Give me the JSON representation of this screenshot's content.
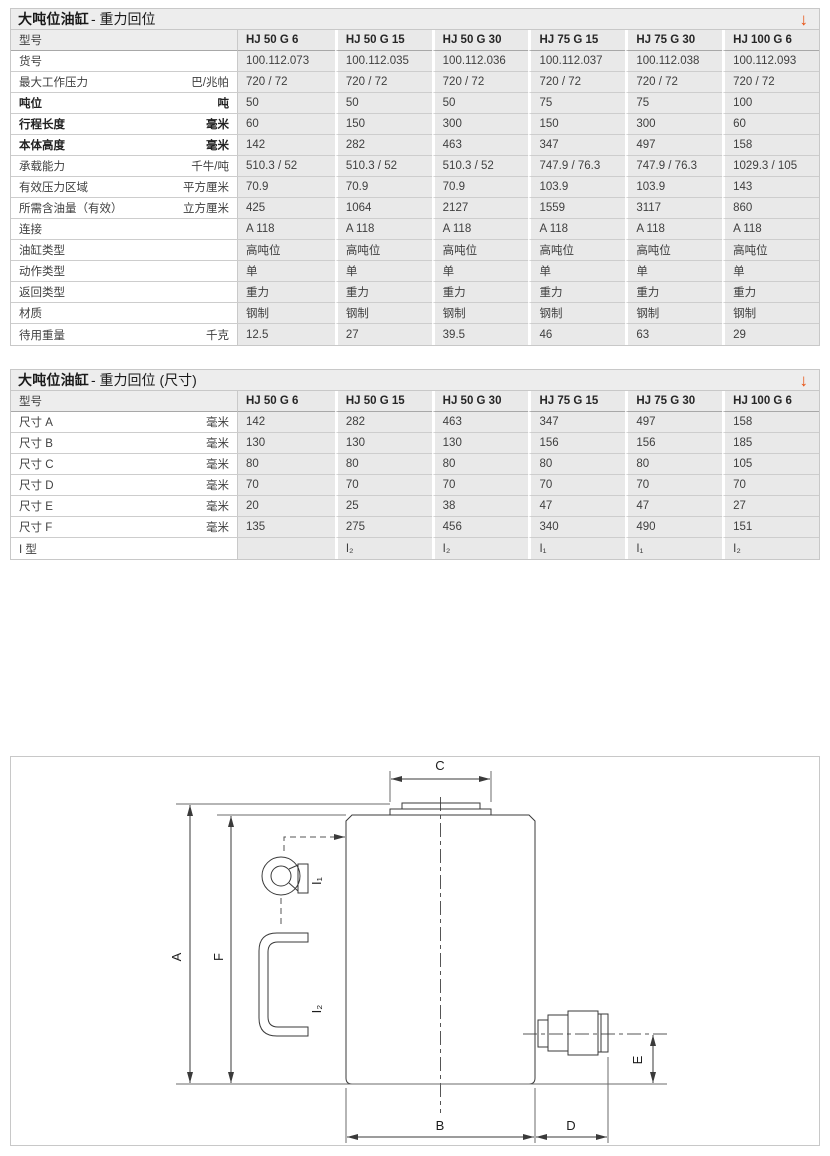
{
  "accent_color": "#E8500F",
  "download_icon": "↓",
  "tables": [
    {
      "title_bold": "大吨位油缸",
      "title_rest": " - 重力回位",
      "col_header_label": "型号",
      "columns": [
        "HJ 50 G 6",
        "HJ 50 G 15",
        "HJ 50 G 30",
        "HJ 75 G 15",
        "HJ 75 G 30",
        "HJ 100 G 6"
      ],
      "rows": [
        {
          "label": "货号",
          "unit": "",
          "bold": false,
          "values": [
            "100.112.073",
            "100.112.035",
            "100.112.036",
            "100.112.037",
            "100.112.038",
            "100.112.093"
          ]
        },
        {
          "label": "最大工作压力",
          "unit": "巴/兆帕",
          "bold": false,
          "values": [
            "720 / 72",
            "720 / 72",
            "720 / 72",
            "720 / 72",
            "720 / 72",
            "720 / 72"
          ]
        },
        {
          "label": "吨位",
          "unit": "吨",
          "bold": true,
          "values": [
            "50",
            "50",
            "50",
            "75",
            "75",
            "100"
          ]
        },
        {
          "label": "行程长度",
          "unit": "毫米",
          "bold": true,
          "values": [
            "60",
            "150",
            "300",
            "150",
            "300",
            "60"
          ]
        },
        {
          "label": "本体高度",
          "unit": "毫米",
          "bold": true,
          "values": [
            "142",
            "282",
            "463",
            "347",
            "497",
            "158"
          ]
        },
        {
          "label": "承载能力",
          "unit": "千牛/吨",
          "bold": false,
          "values": [
            "510.3 / 52",
            "510.3 / 52",
            "510.3 / 52",
            "747.9 / 76.3",
            "747.9 / 76.3",
            "1029.3 / 105"
          ]
        },
        {
          "label": "有效压力区域",
          "unit": "平方厘米",
          "bold": false,
          "values": [
            "70.9",
            "70.9",
            "70.9",
            "103.9",
            "103.9",
            "143"
          ]
        },
        {
          "label": "所需含油量（有效）",
          "unit": "立方厘米",
          "bold": false,
          "values": [
            "425",
            "1064",
            "2127",
            "1559",
            "3117",
            "860"
          ]
        },
        {
          "label": "连接",
          "unit": "",
          "bold": false,
          "values": [
            "A 118",
            "A 118",
            "A 118",
            "A 118",
            "A 118",
            "A 118"
          ]
        },
        {
          "label": "油缸类型",
          "unit": "",
          "bold": false,
          "values": [
            "高吨位",
            "高吨位",
            "高吨位",
            "高吨位",
            "高吨位",
            "高吨位"
          ]
        },
        {
          "label": "动作类型",
          "unit": "",
          "bold": false,
          "values": [
            "单",
            "单",
            "单",
            "单",
            "单",
            "单"
          ]
        },
        {
          "label": "返回类型",
          "unit": "",
          "bold": false,
          "values": [
            "重力",
            "重力",
            "重力",
            "重力",
            "重力",
            "重力"
          ]
        },
        {
          "label": "材质",
          "unit": "",
          "bold": false,
          "values": [
            "钢制",
            "钢制",
            "钢制",
            "钢制",
            "钢制",
            "钢制"
          ]
        },
        {
          "label": "待用重量",
          "unit": "千克",
          "bold": false,
          "values": [
            "12.5",
            "27",
            "39.5",
            "46",
            "63",
            "29"
          ]
        }
      ]
    },
    {
      "title_bold": "大吨位油缸",
      "title_rest": " - 重力回位 (尺寸)",
      "col_header_label": "型号",
      "columns": [
        "HJ 50 G 6",
        "HJ 50 G 15",
        "HJ 50 G 30",
        "HJ 75 G 15",
        "HJ 75 G 30",
        "HJ 100 G 6"
      ],
      "rows": [
        {
          "label": "尺寸 A",
          "unit": "毫米",
          "bold": false,
          "values": [
            "142",
            "282",
            "463",
            "347",
            "497",
            "158"
          ]
        },
        {
          "label": "尺寸 B",
          "unit": "毫米",
          "bold": false,
          "values": [
            "130",
            "130",
            "130",
            "156",
            "156",
            "185"
          ]
        },
        {
          "label": "尺寸 C",
          "unit": "毫米",
          "bold": false,
          "values": [
            "80",
            "80",
            "80",
            "80",
            "80",
            "105"
          ]
        },
        {
          "label": "尺寸 D",
          "unit": "毫米",
          "bold": false,
          "values": [
            "70",
            "70",
            "70",
            "70",
            "70",
            "70"
          ]
        },
        {
          "label": "尺寸 E",
          "unit": "毫米",
          "bold": false,
          "values": [
            "20",
            "25",
            "38",
            "47",
            "47",
            "27"
          ]
        },
        {
          "label": "尺寸 F",
          "unit": "毫米",
          "bold": false,
          "values": [
            "135",
            "275",
            "456",
            "340",
            "490",
            "151"
          ]
        },
        {
          "label": "I 型",
          "unit": "",
          "bold": false,
          "values": [
            "",
            "I₂",
            "I₂",
            "I₁",
            "I₁",
            "I₂"
          ]
        }
      ]
    }
  ],
  "diagram": {
    "dim_labels": {
      "A": "A",
      "B": "B",
      "C": "C",
      "D": "D",
      "E": "E",
      "F": "F"
    },
    "part_labels": {
      "i1": "I₁",
      "i2": "I₂"
    }
  }
}
